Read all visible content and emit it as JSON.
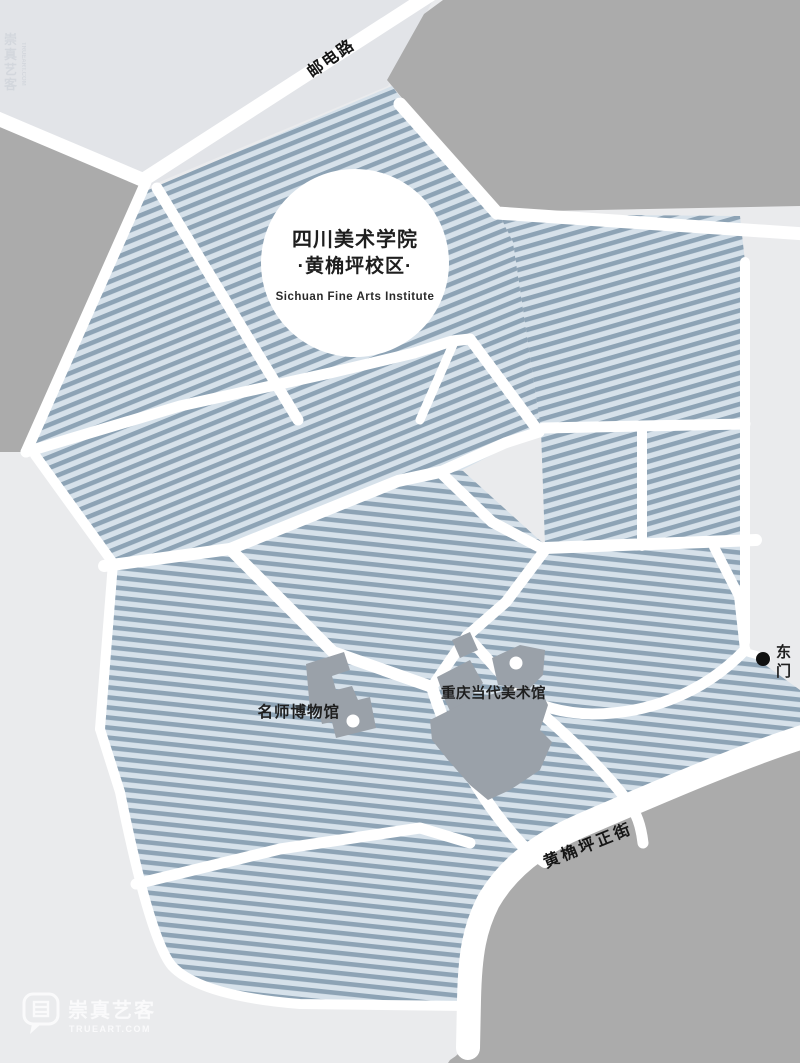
{
  "map": {
    "title_line1": "四川美术学院",
    "title_line2": "·黄桷坪校区·",
    "title_line3": "Sichuan Fine Arts Institute",
    "roads": {
      "youdian": "邮电路",
      "huangjueping": "黄桷坪正街"
    },
    "gates": {
      "east": "东门",
      "east_chars": [
        "东",
        "门"
      ]
    },
    "buildings": {
      "master_museum": "名师博物馆",
      "contemporary_art_museum": "重庆当代美术馆"
    },
    "icons": {
      "gate_marker": "black-dot",
      "museum_entrance_marker": "white-dot",
      "watermark_bubble": "speech-bubble-icon"
    },
    "colors": {
      "background": "#eaebed",
      "top_area": "#e2e4e8",
      "block_gray": "#ababab",
      "building_gray": "#9aa1a9",
      "hatch_light": "#d6e1ea",
      "hatch_dark": "#8da3b5",
      "road_white": "#ffffff",
      "text": "#1e1e1e"
    }
  },
  "watermark": {
    "name": "崇真艺客",
    "domain": "TRUEART.COM",
    "chars": [
      "崇",
      "真",
      "艺",
      "客"
    ]
  }
}
